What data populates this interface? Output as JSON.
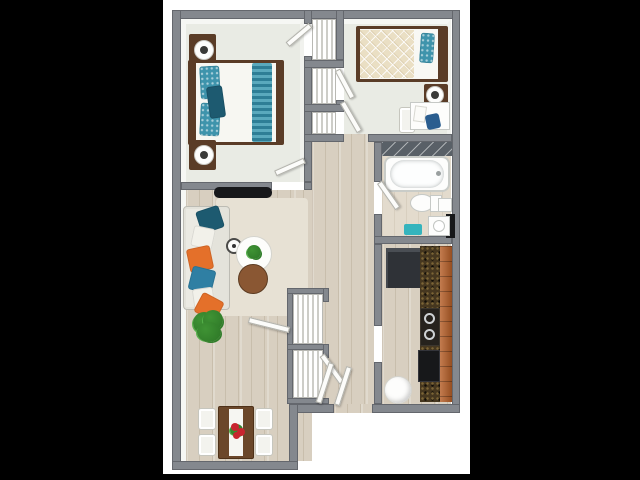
{
  "scene": {
    "type": "3D top-down floor plan render of a two-bedroom apartment",
    "visible_text": "",
    "background": "#000000",
    "canvas_background": "#ffffff"
  },
  "colors": {
    "bg": "#000000",
    "canvas": "#ffffff",
    "wall": "#84888e",
    "wall-face": "#f6f7f4",
    "bedroom-floor": "#e9ebe4",
    "wood": "#d8cfc0",
    "bath-floor": "#e3dbcd",
    "rug": "#e7e1d4",
    "sofa": "#e3e2da",
    "furn-wood": "#5a3c27",
    "side-table": "#8a5733",
    "teal": "#3e94ac",
    "teal-dark": "#1d5a70",
    "orange": "#e4702a",
    "blue": "#2f7fa3",
    "green": "#3f9334",
    "green-dark": "#2c7526",
    "granite": "#46371f",
    "cabinet": "#b65f28",
    "appliance": "#2f3237",
    "black": "#17181a",
    "teal-mat": "#35b4bd",
    "tile": "#596067",
    "red": "#c8242e",
    "blanket": "#eadfc4",
    "dining-table": "#6b472a"
  },
  "rooms": [
    {
      "name": "master-bedroom",
      "furniture": [
        "double-bed",
        "teal-striped-runner",
        "teal-pillows",
        "nightstand",
        "table-lamp",
        "nightstand",
        "table-lamp",
        "closet-shelves",
        "door"
      ]
    },
    {
      "name": "bedroom-2",
      "furniture": [
        "single-bed",
        "diamond-quilt",
        "teal-pillow",
        "nightstand",
        "table-lamp",
        "desk",
        "desk-chair",
        "papers"
      ]
    },
    {
      "name": "bathroom",
      "furniture": [
        "tiled-wall",
        "bathtub",
        "toilet",
        "shelf",
        "dark-cabinet",
        "sink-vanity",
        "teal-bath-mat",
        "door"
      ]
    },
    {
      "name": "kitchen",
      "furniture": [
        "refrigerator",
        "granite-counter",
        "orange-cabinets",
        "stove",
        "oven",
        "water-heater"
      ]
    },
    {
      "name": "living-room",
      "furniture": [
        "wall-tv",
        "sofa",
        "throw-pillows",
        "area-rug",
        "table-clock",
        "coffee-table",
        "potted-plant",
        "side-table",
        "floor-plant"
      ]
    },
    {
      "name": "dining-area",
      "furniture": [
        "dining-table",
        "white-runner",
        "flower-centerpiece",
        "dining-chair",
        "dining-chair",
        "dining-chair",
        "dining-chair"
      ]
    },
    {
      "name": "hallway",
      "furniture": [
        "linen-closet-shelves",
        "entry-closet-shelves",
        "open-doors"
      ]
    }
  ]
}
